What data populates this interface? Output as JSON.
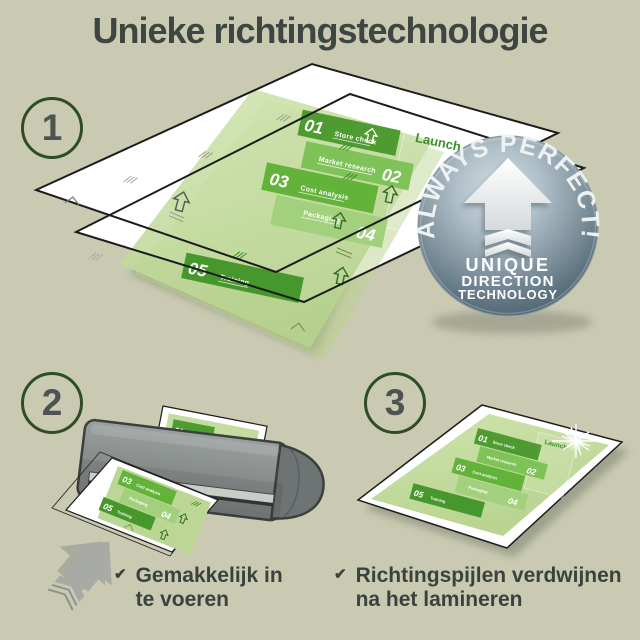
{
  "page": {
    "title": "Unieke richtingstechnologie"
  },
  "steps": {
    "one": "1",
    "two": "2",
    "three": "3"
  },
  "badge": {
    "arc_text": "ALWAYS PERFECT!",
    "line1": "UNIQUE",
    "line2": "DIRECTION",
    "line3": "TECHNOLOGY"
  },
  "doc": {
    "header": "Launch",
    "items": [
      {
        "num": "01",
        "label": "Store check"
      },
      {
        "num": "02",
        "label": "Market research"
      },
      {
        "num": "03",
        "label": "Cost analysis"
      },
      {
        "num": "04",
        "label": "Packaging"
      },
      {
        "num": "05",
        "label": "Training"
      }
    ]
  },
  "checklist": [
    {
      "check": "✔",
      "line1": "Gemakkelijk in",
      "line2": "te voeren"
    },
    {
      "check": "✔",
      "line1": "Richtingspijlen verdwijnen",
      "line2": "na het lamineren"
    }
  ],
  "colors": {
    "background": "#c9cab1",
    "text": "#3d4642",
    "circle_ring": "#2e4d24",
    "doc_green_dark": "#4e9c31",
    "doc_green_mid": "#7fc258",
    "doc_green_light": "#a3d07c",
    "badge_gray_blue": "#7b8f9c",
    "laminator_gray": "#8d9292"
  }
}
